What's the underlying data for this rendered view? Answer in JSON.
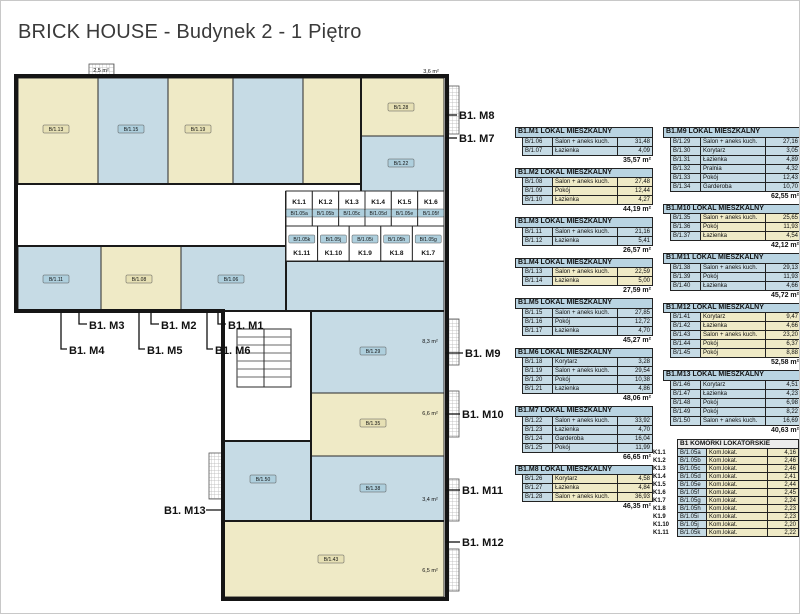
{
  "title": "BRICK HOUSE - Budynek 2 - 1 Piętro",
  "colors": {
    "room_blue": "#c6dbe5",
    "room_cream": "#efeac6",
    "header_blue": "#b9d4e2",
    "wall": "#151515",
    "chip_blue": "#aecfdd",
    "chip_cream": "#e6e0b4"
  },
  "apartments": [
    {
      "id": "B1.M1",
      "header": "B1.M1 LOKAL MIESZKALNY",
      "scheme": "blue",
      "column": 1,
      "rooms": [
        {
          "code": "B/1.06",
          "name": "Salon + aneks kuch.",
          "area": "31,48"
        },
        {
          "code": "B/1.07",
          "name": "Łazienka",
          "area": "4,09"
        }
      ],
      "total": "35,57 m²"
    },
    {
      "id": "B1.M2",
      "header": "B1.M2 LOKAL MIESZKALNY",
      "scheme": "cream",
      "column": 1,
      "rooms": [
        {
          "code": "B/1.08",
          "name": "Salon + aneks kuch.",
          "area": "27,48"
        },
        {
          "code": "B/1.09",
          "name": "Pokój",
          "area": "12,44"
        },
        {
          "code": "B/1.10",
          "name": "Łazienka",
          "area": "4,27"
        }
      ],
      "total": "44,19 m²"
    },
    {
      "id": "B1.M3",
      "header": "B1.M3 LOKAL MIESZKALNY",
      "scheme": "blue",
      "column": 1,
      "rooms": [
        {
          "code": "B/1.11",
          "name": "Salon + aneks kuch.",
          "area": "21,16"
        },
        {
          "code": "B/1.12",
          "name": "Łazienka",
          "area": "5,41"
        }
      ],
      "total": "26,57 m²"
    },
    {
      "id": "B1.M4",
      "header": "B1.M4 LOKAL MIESZKALNY",
      "scheme": "cream",
      "column": 1,
      "rooms": [
        {
          "code": "B/1.13",
          "name": "Salon + aneks kuch.",
          "area": "22,59"
        },
        {
          "code": "B/1.14",
          "name": "Łazienka",
          "area": "5,00"
        }
      ],
      "total": "27,59 m²"
    },
    {
      "id": "B1.M5",
      "header": "B1.M5 LOKAL MIESZKALNY",
      "scheme": "blue",
      "column": 1,
      "rooms": [
        {
          "code": "B/1.15",
          "name": "Salon + aneks kuch.",
          "area": "27,85"
        },
        {
          "code": "B/1.16",
          "name": "Pokój",
          "area": "12,72"
        },
        {
          "code": "B/1.17",
          "name": "Łazienka",
          "area": "4,70"
        }
      ],
      "total": "45,27 m²"
    },
    {
      "id": "B1.M6",
      "header": "B1.M6 LOKAL MIESZKALNY",
      "scheme": "blue",
      "column": 1,
      "rooms": [
        {
          "code": "B/1.18",
          "name": "Korytarz",
          "area": "3,28"
        },
        {
          "code": "B/1.19",
          "name": "Salon + aneks kuch.",
          "area": "29,54"
        },
        {
          "code": "B/1.20",
          "name": "Pokój",
          "area": "10,38"
        },
        {
          "code": "B/1.21",
          "name": "Łazienka",
          "area": "4,86"
        }
      ],
      "total": "48,06 m²"
    },
    {
      "id": "B1.M7",
      "header": "B1.M7 LOKAL MIESZKALNY",
      "scheme": "blue",
      "column": 1,
      "rooms": [
        {
          "code": "B/1.22",
          "name": "Salon + aneks kuch.",
          "area": "33,92"
        },
        {
          "code": "B/1.23",
          "name": "Łazienka",
          "area": "4,70"
        },
        {
          "code": "B/1.24",
          "name": "Garderoba",
          "area": "16,04"
        },
        {
          "code": "B/1.25",
          "name": "Pokój",
          "area": "11,99"
        }
      ],
      "total": "66,65 m²"
    },
    {
      "id": "B1.M8",
      "header": "B1.M8 LOKAL MIESZKALNY",
      "scheme": "cream",
      "column": 1,
      "rooms": [
        {
          "code": "B/1.26",
          "name": "Korytarz",
          "area": "4,58"
        },
        {
          "code": "B/1.27",
          "name": "Łazienka",
          "area": "4,84"
        },
        {
          "code": "B/1.28",
          "name": "Salon + aneks kuch.",
          "area": "36,93"
        }
      ],
      "total": "46,35 m²"
    },
    {
      "id": "B1.M9",
      "header": "B1.M9 LOKAL MIESZKALNY",
      "scheme": "blue",
      "column": 2,
      "rooms": [
        {
          "code": "B/1.29",
          "name": "Salon + aneks kuch.",
          "area": "27,16"
        },
        {
          "code": "B/1.30",
          "name": "Korytarz",
          "area": "3,05"
        },
        {
          "code": "B/1.31",
          "name": "Łazienka",
          "area": "4,89"
        },
        {
          "code": "B/1.32",
          "name": "Pralnia",
          "area": "4,32"
        },
        {
          "code": "B/1.33",
          "name": "Pokój",
          "area": "12,43"
        },
        {
          "code": "B/1.34",
          "name": "Garderoba",
          "area": "10,70"
        }
      ],
      "total": "62,55 m²"
    },
    {
      "id": "B1.M10",
      "header": "B1.M10 LOKAL MIESZKALNY",
      "scheme": "cream",
      "column": 2,
      "rooms": [
        {
          "code": "B/1.35",
          "name": "Salon + aneks kuch.",
          "area": "25,65"
        },
        {
          "code": "B/1.36",
          "name": "Pokój",
          "area": "11,93"
        },
        {
          "code": "B/1.37",
          "name": "Łazienka",
          "area": "4,54"
        }
      ],
      "total": "42,12 m²"
    },
    {
      "id": "B1.M11",
      "header": "B1.M11 LOKAL MIESZKALNY",
      "scheme": "blue",
      "column": 2,
      "rooms": [
        {
          "code": "B/1.38",
          "name": "Salon + aneks kuch.",
          "area": "29,13"
        },
        {
          "code": "B/1.39",
          "name": "Pokój",
          "area": "11,93"
        },
        {
          "code": "B/1.40",
          "name": "Łazienka",
          "area": "4,66"
        }
      ],
      "total": "45,72 m²"
    },
    {
      "id": "B1.M12",
      "header": "B1.M12 LOKAL MIESZKALNY",
      "scheme": "cream",
      "column": 2,
      "rooms": [
        {
          "code": "B/1.41",
          "name": "Korytarz",
          "area": "9,47"
        },
        {
          "code": "B/1.42",
          "name": "Łazienka",
          "area": "4,66"
        },
        {
          "code": "B/1.43",
          "name": "Salon + aneks kuch.",
          "area": "23,20"
        },
        {
          "code": "B/1.44",
          "name": "Pokój",
          "area": "6,37"
        },
        {
          "code": "B/1.45",
          "name": "Pokój",
          "area": "8,88"
        }
      ],
      "total": "52,58 m²"
    },
    {
      "id": "B1.M13",
      "header": "B1.M13 LOKAL MIESZKALNY",
      "scheme": "blue",
      "column": 2,
      "rooms": [
        {
          "code": "B/1.46",
          "name": "Korytarz",
          "area": "4,51"
        },
        {
          "code": "B/1.47",
          "name": "Łazienka",
          "area": "4,23"
        },
        {
          "code": "B/1.48",
          "name": "Pokój",
          "area": "6,98"
        },
        {
          "code": "B/1.49",
          "name": "Pokój",
          "area": "8,22"
        },
        {
          "code": "B/1.50",
          "name": "Salon + aneks kuch.",
          "area": "16,69"
        }
      ],
      "total": "40,63 m²"
    }
  ],
  "storage": {
    "header": "B1 KOMÓRKI LOKATORSKIE",
    "unit_name": "Kom.lokat.",
    "rows": [
      {
        "label": "K1.1",
        "code": "B/1.05a",
        "area": "4,16"
      },
      {
        "label": "K1.2",
        "code": "B/1.05b",
        "area": "2,46"
      },
      {
        "label": "K1.3",
        "code": "B/1.05c",
        "area": "2,46"
      },
      {
        "label": "K1.4",
        "code": "B/1.05d",
        "area": "2,41"
      },
      {
        "label": "K1.5",
        "code": "B/1.05e",
        "area": "2,44"
      },
      {
        "label": "K1.6",
        "code": "B/1.05f",
        "area": "2,45"
      },
      {
        "label": "K1.7",
        "code": "B/1.05g",
        "area": "2,24"
      },
      {
        "label": "K1.8",
        "code": "B/1.05h",
        "area": "2,23"
      },
      {
        "label": "K1.9",
        "code": "B/1.05i",
        "area": "2,23"
      },
      {
        "label": "K1.10",
        "code": "B/1.05j",
        "area": "2,20"
      },
      {
        "label": "K1.11",
        "code": "B/1.05k",
        "area": "2,22"
      }
    ]
  },
  "plan": {
    "callouts": [
      {
        "id": "m8",
        "label": "B1. M8",
        "x": 458,
        "y": 118,
        "leader": [
          [
            444,
            114
          ],
          [
            456,
            114
          ]
        ]
      },
      {
        "id": "m7",
        "label": "B1. M7",
        "x": 458,
        "y": 141,
        "leader": [
          [
            444,
            137
          ],
          [
            456,
            137
          ]
        ]
      },
      {
        "id": "m3",
        "label": "B1. M3",
        "x": 88,
        "y": 328,
        "leader": [
          [
            78,
            311
          ],
          [
            78,
            323
          ],
          [
            86,
            323
          ]
        ]
      },
      {
        "id": "m2",
        "label": "B1. M2",
        "x": 160,
        "y": 328,
        "leader": [
          [
            150,
            311
          ],
          [
            150,
            323
          ],
          [
            158,
            323
          ]
        ]
      },
      {
        "id": "m1",
        "label": "B1. M1",
        "x": 227,
        "y": 328,
        "leader": [
          [
            217,
            311
          ],
          [
            217,
            323
          ],
          [
            225,
            323
          ]
        ]
      },
      {
        "id": "m4",
        "label": "B1. M4",
        "x": 68,
        "y": 353,
        "leader": [
          [
            60,
            311
          ],
          [
            60,
            348
          ],
          [
            66,
            348
          ]
        ]
      },
      {
        "id": "m5",
        "label": "B1. M5",
        "x": 146,
        "y": 353,
        "leader": [
          [
            138,
            311
          ],
          [
            138,
            348
          ],
          [
            144,
            348
          ]
        ]
      },
      {
        "id": "m6",
        "label": "B1. M6",
        "x": 214,
        "y": 353,
        "leader": [
          [
            206,
            311
          ],
          [
            206,
            348
          ],
          [
            212,
            348
          ]
        ]
      },
      {
        "id": "m9",
        "label": "B1. M9",
        "x": 464,
        "y": 356,
        "leader": [
          [
            444,
            352
          ],
          [
            462,
            352
          ]
        ]
      },
      {
        "id": "m10",
        "label": "B1. M10",
        "x": 461,
        "y": 417,
        "leader": [
          [
            444,
            413
          ],
          [
            459,
            413
          ]
        ]
      },
      {
        "id": "m11",
        "label": "B1. M11",
        "x": 461,
        "y": 493,
        "leader": [
          [
            444,
            489
          ],
          [
            459,
            489
          ]
        ]
      },
      {
        "id": "m12",
        "label": "B1. M12",
        "x": 461,
        "y": 545,
        "leader": [
          [
            444,
            541
          ],
          [
            459,
            541
          ]
        ]
      },
      {
        "id": "m13",
        "label": "B1. M13",
        "x": 163,
        "y": 513,
        "leader": [
          [
            222,
            509
          ],
          [
            205,
            509
          ]
        ]
      }
    ],
    "storage_top": {
      "labels": [
        "K1.1",
        "K1.2",
        "K1.3",
        "K1.4",
        "K1.5",
        "K1.6"
      ],
      "codes": [
        "B/1.05a",
        "B/1.05b",
        "B/1.05c",
        "B/1.05d",
        "B/1.05e",
        "B/1.05f"
      ]
    },
    "storage_bottom": {
      "labels": [
        "K1.11",
        "K1.10",
        "K1.9",
        "K1.8",
        "K1.7"
      ],
      "codes": [
        "B/1.05k",
        "B/1.05j",
        "B/1.05i",
        "B/1.05h",
        "B/1.05g"
      ]
    },
    "room_chips": [
      {
        "code": "B/1.13",
        "x": 55,
        "y": 128,
        "scheme": "cream"
      },
      {
        "code": "B/1.15",
        "x": 130,
        "y": 128,
        "scheme": "blue"
      },
      {
        "code": "B/1.19",
        "x": 197,
        "y": 128,
        "scheme": "cream"
      },
      {
        "code": "B/1.28",
        "x": 400,
        "y": 106,
        "scheme": "cream"
      },
      {
        "code": "B/1.22",
        "x": 400,
        "y": 162,
        "scheme": "blue"
      },
      {
        "code": "B/1.11",
        "x": 55,
        "y": 278,
        "scheme": "blue"
      },
      {
        "code": "B/1.08",
        "x": 138,
        "y": 278,
        "scheme": "cream"
      },
      {
        "code": "B/1.06",
        "x": 230,
        "y": 278,
        "scheme": "blue"
      },
      {
        "code": "B/1.29",
        "x": 372,
        "y": 350,
        "scheme": "blue"
      },
      {
        "code": "B/1.35",
        "x": 372,
        "y": 422,
        "scheme": "cream"
      },
      {
        "code": "B/1.38",
        "x": 372,
        "y": 487,
        "scheme": "blue"
      },
      {
        "code": "B/1.43",
        "x": 330,
        "y": 558,
        "scheme": "cream"
      },
      {
        "code": "B/1.50",
        "x": 262,
        "y": 478,
        "scheme": "blue"
      }
    ],
    "balcony_labels": [
      {
        "text": "2,5 m²",
        "x": 100,
        "y": 71
      },
      {
        "text": "3,6 m²",
        "x": 430,
        "y": 72
      },
      {
        "text": "8,3 m²",
        "x": 429,
        "y": 342
      },
      {
        "text": "6,6 m²",
        "x": 429,
        "y": 414
      },
      {
        "text": "3,4 m²",
        "x": 429,
        "y": 500
      },
      {
        "text": "6,5 m²",
        "x": 429,
        "y": 571
      }
    ]
  }
}
